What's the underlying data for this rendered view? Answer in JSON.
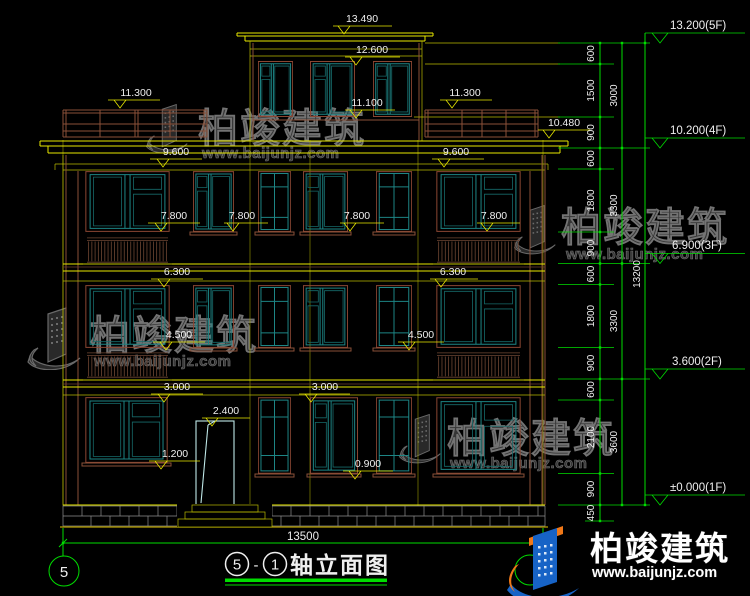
{
  "colors": {
    "background": "#000000",
    "dim_yellow": "#e8e800",
    "chain_green": "#00dd00",
    "window_teal": "#1d8585",
    "wall_brown": "#8a5038",
    "door_cyan": "#bfe8e8",
    "stone_gray": "#8f8f8f",
    "text_white": "#efefef",
    "watermark_gray": "#3b3b3b",
    "logo_blue": "#1763c6",
    "logo_orange": "#f07818"
  },
  "dims": {
    "top": "13.490",
    "parapet": "12.600",
    "rail": "11.300",
    "ph_sill": "11.100",
    "eave": "10.480",
    "head3": "9.600",
    "sill3": "7.800",
    "head2": "6.300",
    "sill2": "4.500",
    "head1": "3.000",
    "door_top": "2.400",
    "sill1_left": "1.200",
    "sill1_right": "0.900",
    "overall_width": "13500"
  },
  "chain": {
    "inner": [
      "600",
      "1500",
      "900",
      "600",
      "1800",
      "900",
      "600",
      "1800",
      "900",
      "600",
      "2100",
      "900",
      "450"
    ],
    "middle": [
      "3000",
      "3300",
      "3300",
      "3600"
    ],
    "overall": "13200",
    "floors": [
      "13.200(5F)",
      "10.200(4F)",
      "6.900(3F)",
      "3.600(2F)",
      "±0.000(1F)"
    ]
  },
  "title": {
    "axis_left": "5",
    "separator": "-",
    "axis_right": "1",
    "text": "轴立面图"
  },
  "axis_bubble": {
    "left": "5"
  },
  "watermark": {
    "brand": "柏竣建筑",
    "url": "www.baijunjz.com"
  },
  "footer": {
    "brand": "柏竣建筑",
    "url": "www.baijunjz.com"
  }
}
